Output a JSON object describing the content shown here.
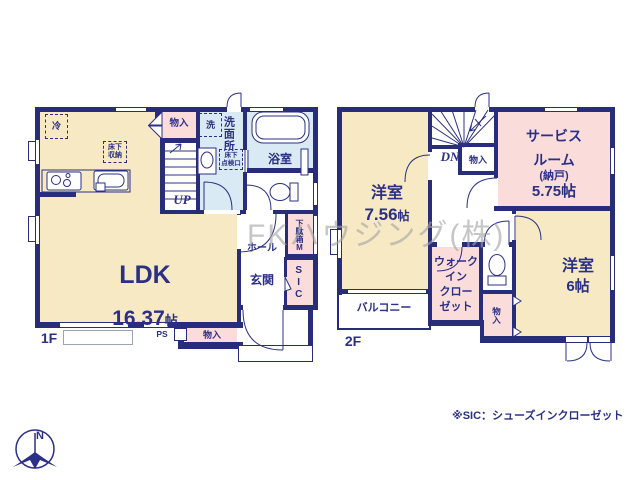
{
  "watermark": "FKハウジング(株)",
  "footnote": "※SIC：シューズインクローゼット",
  "compass_n": "N",
  "colors": {
    "wall": "#272c7b",
    "text": "#2b3086",
    "cream": "#f6e9c3",
    "pink": "#fadcda",
    "blue": "#daeaf4"
  },
  "floor1": {
    "label": "1F",
    "ldk_name": "LDK",
    "ldk_size": "16.37",
    "ldk_unit": "帖",
    "fridge": "冷",
    "underfloor_storage": "床下\n収納",
    "closet_top": "物入",
    "washer": "洗",
    "washroom": "洗面所",
    "inspection_hatch": "床下\n点検口",
    "bathroom": "浴室",
    "stairs_up": "UP",
    "hall": "ホール",
    "entrance": "玄関",
    "shoe_box": "下駄箱M",
    "shoe_closet": "SIC",
    "pipe_space": "PS",
    "closet_bottom": "物入"
  },
  "floor2": {
    "label": "2F",
    "bedroom1_name": "洋室",
    "bedroom1_size": "7.56",
    "bedroom1_unit": "帖",
    "stairs_down": "DN",
    "closet_stairs": "物入",
    "service_room_line1": "サービス",
    "service_room_line2": "ルーム",
    "service_room_line3": "(納戸)",
    "service_room_line4": "5.75帖",
    "wic_line1": "ウォーク",
    "wic_line2": "イン",
    "wic_line3": "クロー",
    "wic_line4": "ゼット",
    "balcony": "バルコニー",
    "bedroom2_name": "洋室",
    "bedroom2_size": "6帖",
    "closet_small": "物入"
  }
}
